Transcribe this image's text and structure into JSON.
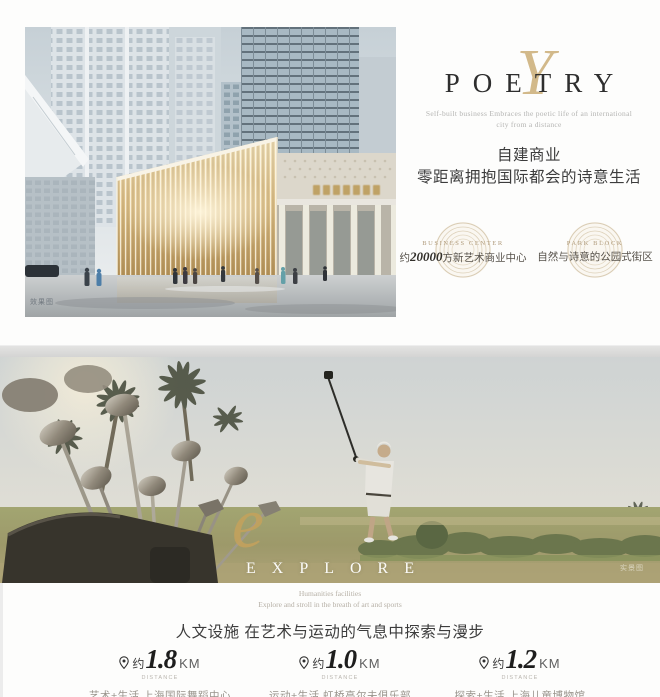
{
  "top_section": {
    "watermark": "效果图",
    "title_en": "POETRY",
    "script_letter": "Y",
    "subtitle_line1": "Self-built business Embraces the poetic life of an international",
    "subtitle_line2": "city from a distance",
    "heading_cn_line1": "自建商业",
    "heading_cn_line2": "零距离拥抱国际都会的诗意生活",
    "badges": [
      {
        "label_en": "BUSINESS CENTER",
        "cn_prefix": "约",
        "cn_number": "20000",
        "cn_suffix": "方新艺术商业中心"
      },
      {
        "label_en": "PARK BLOCK",
        "cn_text": "自然与诗意的公园式街区"
      }
    ]
  },
  "bottom_section": {
    "watermark": "实景图",
    "title_en": "EXPLORE",
    "script_letter": "e",
    "subtitle_line1": "Humanities facilities",
    "subtitle_line2": "Explore and stroll in the breath of art and sports",
    "heading_cn": "人文设施 在艺术与运动的气息中探索与漫步",
    "distances": [
      {
        "prefix": "约",
        "value": "1.8",
        "unit": "KM",
        "caption": "DISTANCE",
        "label": "艺术+生活 上海国际舞蹈中心"
      },
      {
        "prefix": "约",
        "value": "1.0",
        "unit": "KM",
        "caption": "DISTANCE",
        "label": "运动+生活 虹桥高尔夫俱乐部"
      },
      {
        "prefix": "约",
        "value": "1.2",
        "unit": "KM",
        "caption": "DISTANCE",
        "label": "探索+生活 上海儿童博物馆"
      }
    ]
  },
  "colors": {
    "gold": "#c8a96e",
    "dark_text": "#3c3c3c",
    "muted_text": "#98938b",
    "divider": "#d4d4d3"
  }
}
